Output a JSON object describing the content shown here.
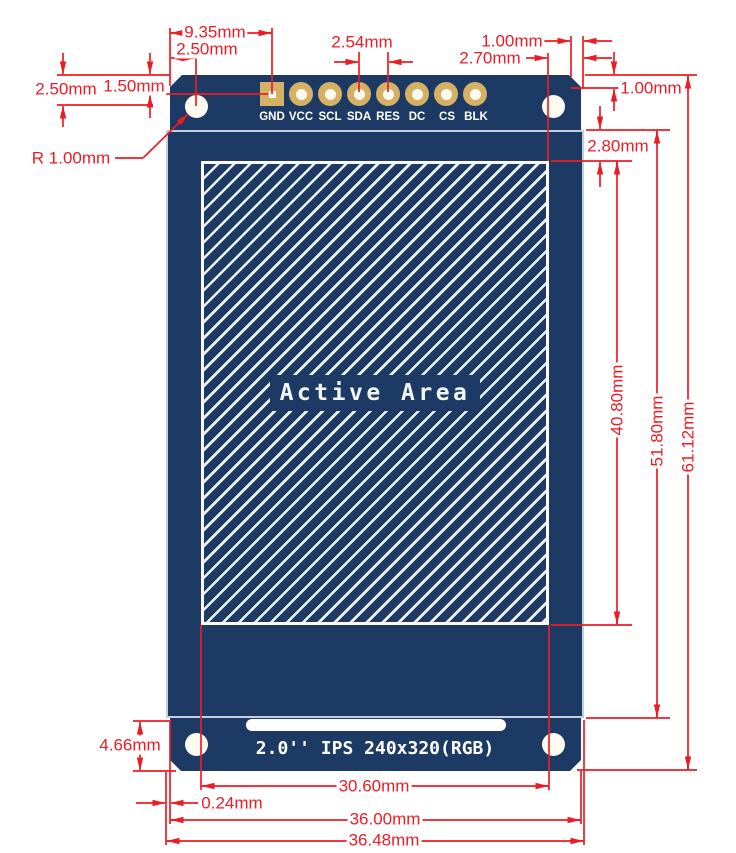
{
  "board": {
    "active_area_label": "Active Area",
    "silk_label": "2.0'' IPS 240x320(RGB)",
    "pins": [
      "GND",
      "VCC",
      "SCL",
      "SDA",
      "RES",
      "DC",
      "CS",
      "BLK"
    ]
  },
  "dimensions": {
    "pad_offset_x": "9.35mm",
    "hole_offset_x": "2.50mm",
    "hole_offset_y": "2.50mm",
    "pad_offset_y": "1.50mm",
    "hole_radius": "R 1.00mm",
    "pin_pitch": "2.54mm",
    "chamfer_width": "1.00mm",
    "active_edge_gap": "2.70mm",
    "chamfer_height": "1.00mm",
    "active_top_gap": "2.80mm",
    "active_height": "40.80mm",
    "glass_height": "51.80mm",
    "board_height": "61.12mm",
    "tab_height": "4.66mm",
    "active_width": "30.60mm",
    "glass_overhang": "0.24mm",
    "board_width": "36.00mm",
    "glass_width": "36.48mm"
  },
  "colors": {
    "board_navy": "#1c3a64",
    "pad_gold": "#d4b164",
    "dimension_red": "#ed1c24",
    "glass_border": "#c3cfda",
    "silk_white": "#ffffff"
  }
}
